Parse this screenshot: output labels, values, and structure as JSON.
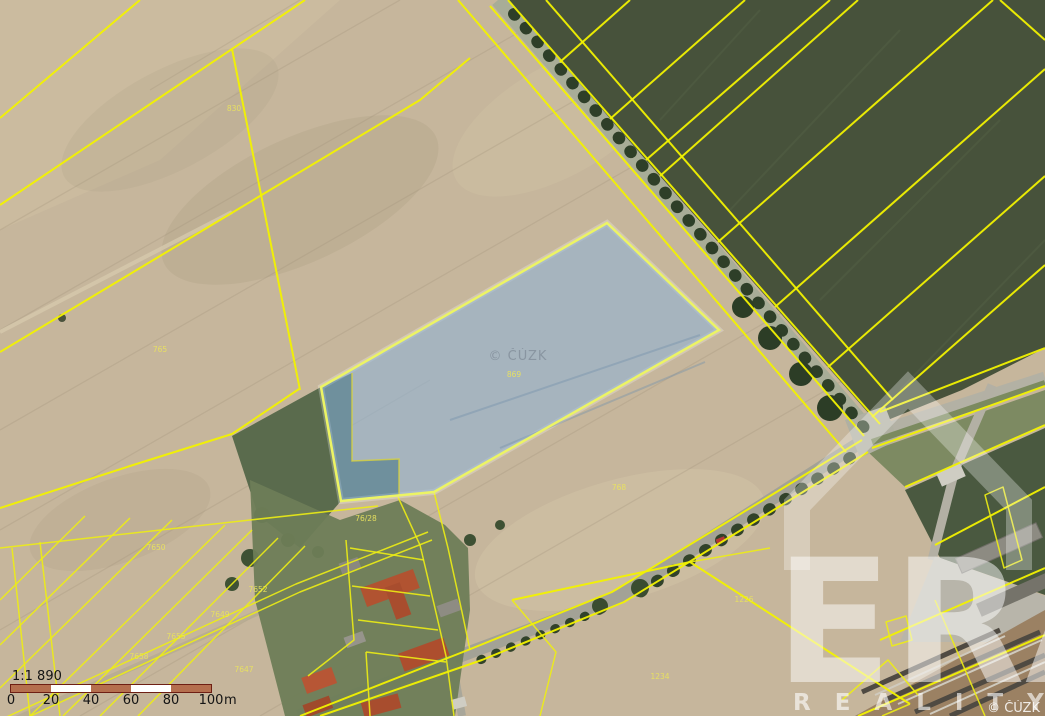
{
  "map": {
    "description_labels": [],
    "parcel_labels": [
      {
        "text": "830",
        "x": 234,
        "y": 111
      },
      {
        "text": "765",
        "x": 160,
        "y": 352
      },
      {
        "text": "869",
        "x": 514,
        "y": 377
      },
      {
        "text": "768",
        "x": 619,
        "y": 490
      },
      {
        "text": "76/28",
        "x": 366,
        "y": 521
      },
      {
        "text": "7650",
        "x": 156,
        "y": 550
      },
      {
        "text": "7652",
        "x": 258,
        "y": 592
      },
      {
        "text": "7649",
        "x": 220,
        "y": 617
      },
      {
        "text": "7655",
        "x": 176,
        "y": 639
      },
      {
        "text": "7658",
        "x": 139,
        "y": 659
      },
      {
        "text": "7647",
        "x": 244,
        "y": 672
      },
      {
        "text": "1234",
        "x": 660,
        "y": 679
      },
      {
        "text": "1226",
        "x": 744,
        "y": 602
      }
    ]
  },
  "watermarks": {
    "center_copyright": "© ČÚZK",
    "corner_copyright": "© ČÚZK",
    "brand": "ERA",
    "brand_sub": "REALITY"
  },
  "scale": {
    "ratio": "1:1 890",
    "ticks": [
      "0",
      "20",
      "40",
      "60",
      "80",
      "100"
    ],
    "unit": "m"
  },
  "colors": {
    "cadastral_line": "#f2f200",
    "selection_border": "#ecf464",
    "selection_fill": "#8fb4d8",
    "field_tan": "#c6b69c",
    "field_green": "#47523b",
    "scale_bar_red": "#b56f4e",
    "scale_bar_border": "#6e1f14"
  }
}
